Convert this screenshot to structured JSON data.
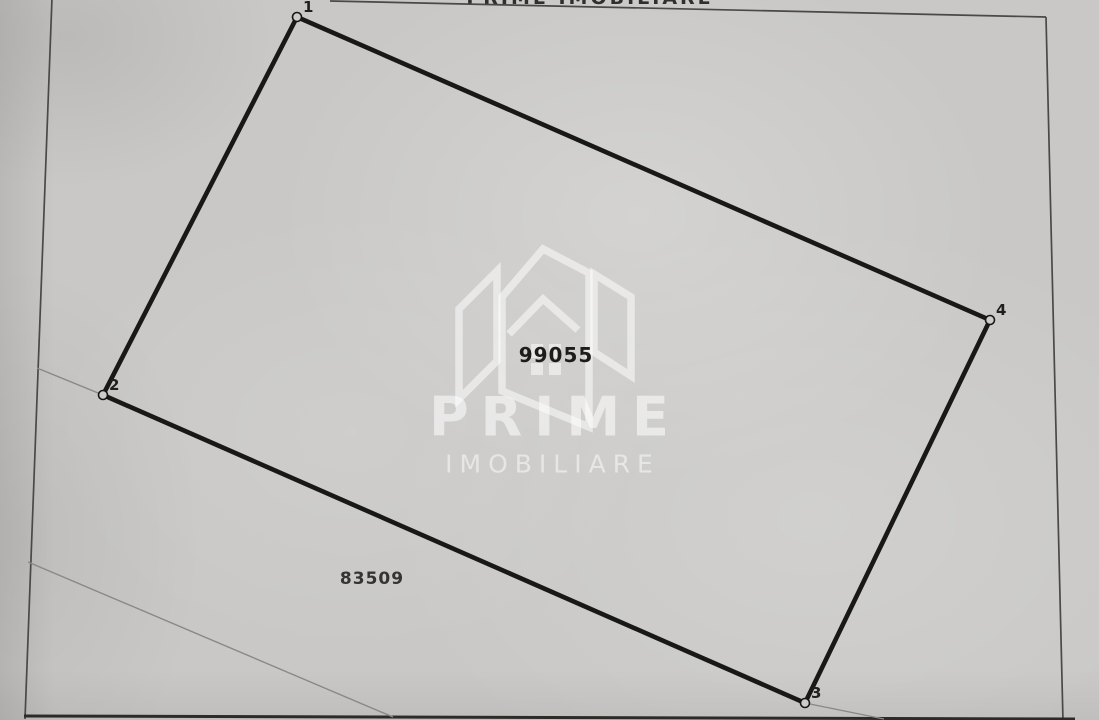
{
  "page": {
    "top_cutoff_text": "PRIME IMOBILIARE"
  },
  "watermark": {
    "brand": "PRIME",
    "subtitle": "IMOBILIARE",
    "icon": "house-logo",
    "brand_pos": {
      "x": 549,
      "y": 417
    },
    "subtitle_pos": {
      "x": 549,
      "y": 464
    }
  },
  "plan": {
    "vertices": [
      {
        "label": "1",
        "x": 297,
        "y": 17
      },
      {
        "label": "2",
        "x": 103,
        "y": 395
      },
      {
        "label": "3",
        "x": 805,
        "y": 703
      },
      {
        "label": "4",
        "x": 990,
        "y": 320
      }
    ],
    "parcel_numbers": [
      {
        "value": "99055",
        "x": 556,
        "y": 355
      },
      {
        "value": "83509",
        "x": 372,
        "y": 579
      }
    ]
  },
  "colors": {
    "paper": "#c9c8c6",
    "parcel_boundary": "#181816",
    "page_frame": "#4a4945",
    "faint_boundary": "#8a8884",
    "watermark": "#ffffff",
    "label_text": "#1f1f1d"
  }
}
